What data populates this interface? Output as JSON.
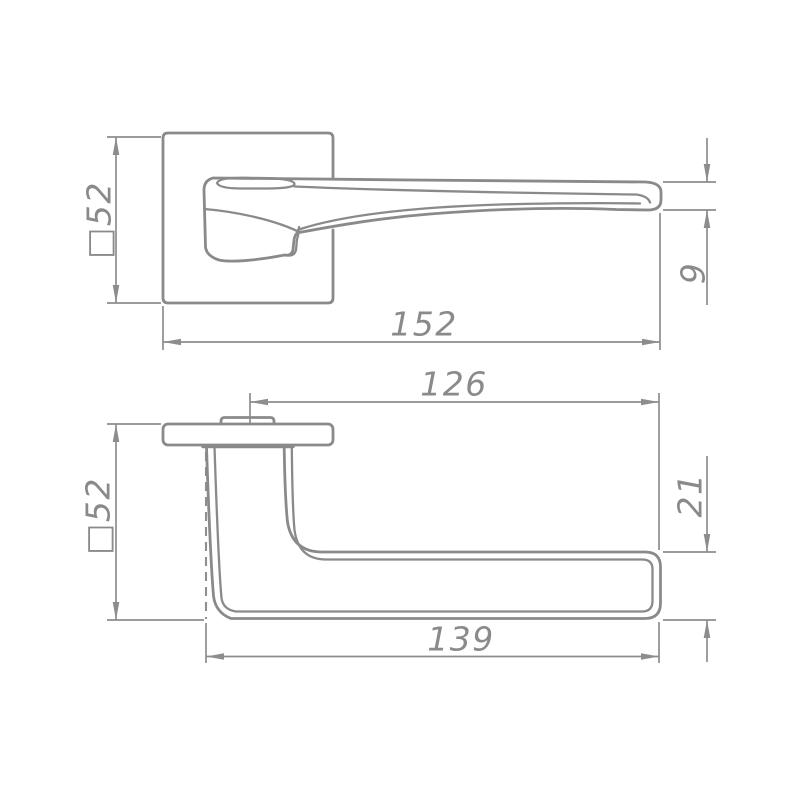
{
  "drawing": {
    "type": "technical-dimension-drawing",
    "subject": "door lever handle on square rosette, two orthographic views",
    "line_color": "#8a8a8a",
    "background": "#ffffff",
    "units": "mm",
    "views": {
      "front": {
        "name": "front view (rosette face with lever)",
        "dims": {
          "rosette": "□52",
          "length": "152",
          "tip_thickness": "9"
        }
      },
      "side": {
        "name": "side profile view",
        "dims": {
          "center_to_tip": "126",
          "rosette": "□52",
          "grip_section": "21",
          "grip_length": "139"
        }
      }
    }
  }
}
